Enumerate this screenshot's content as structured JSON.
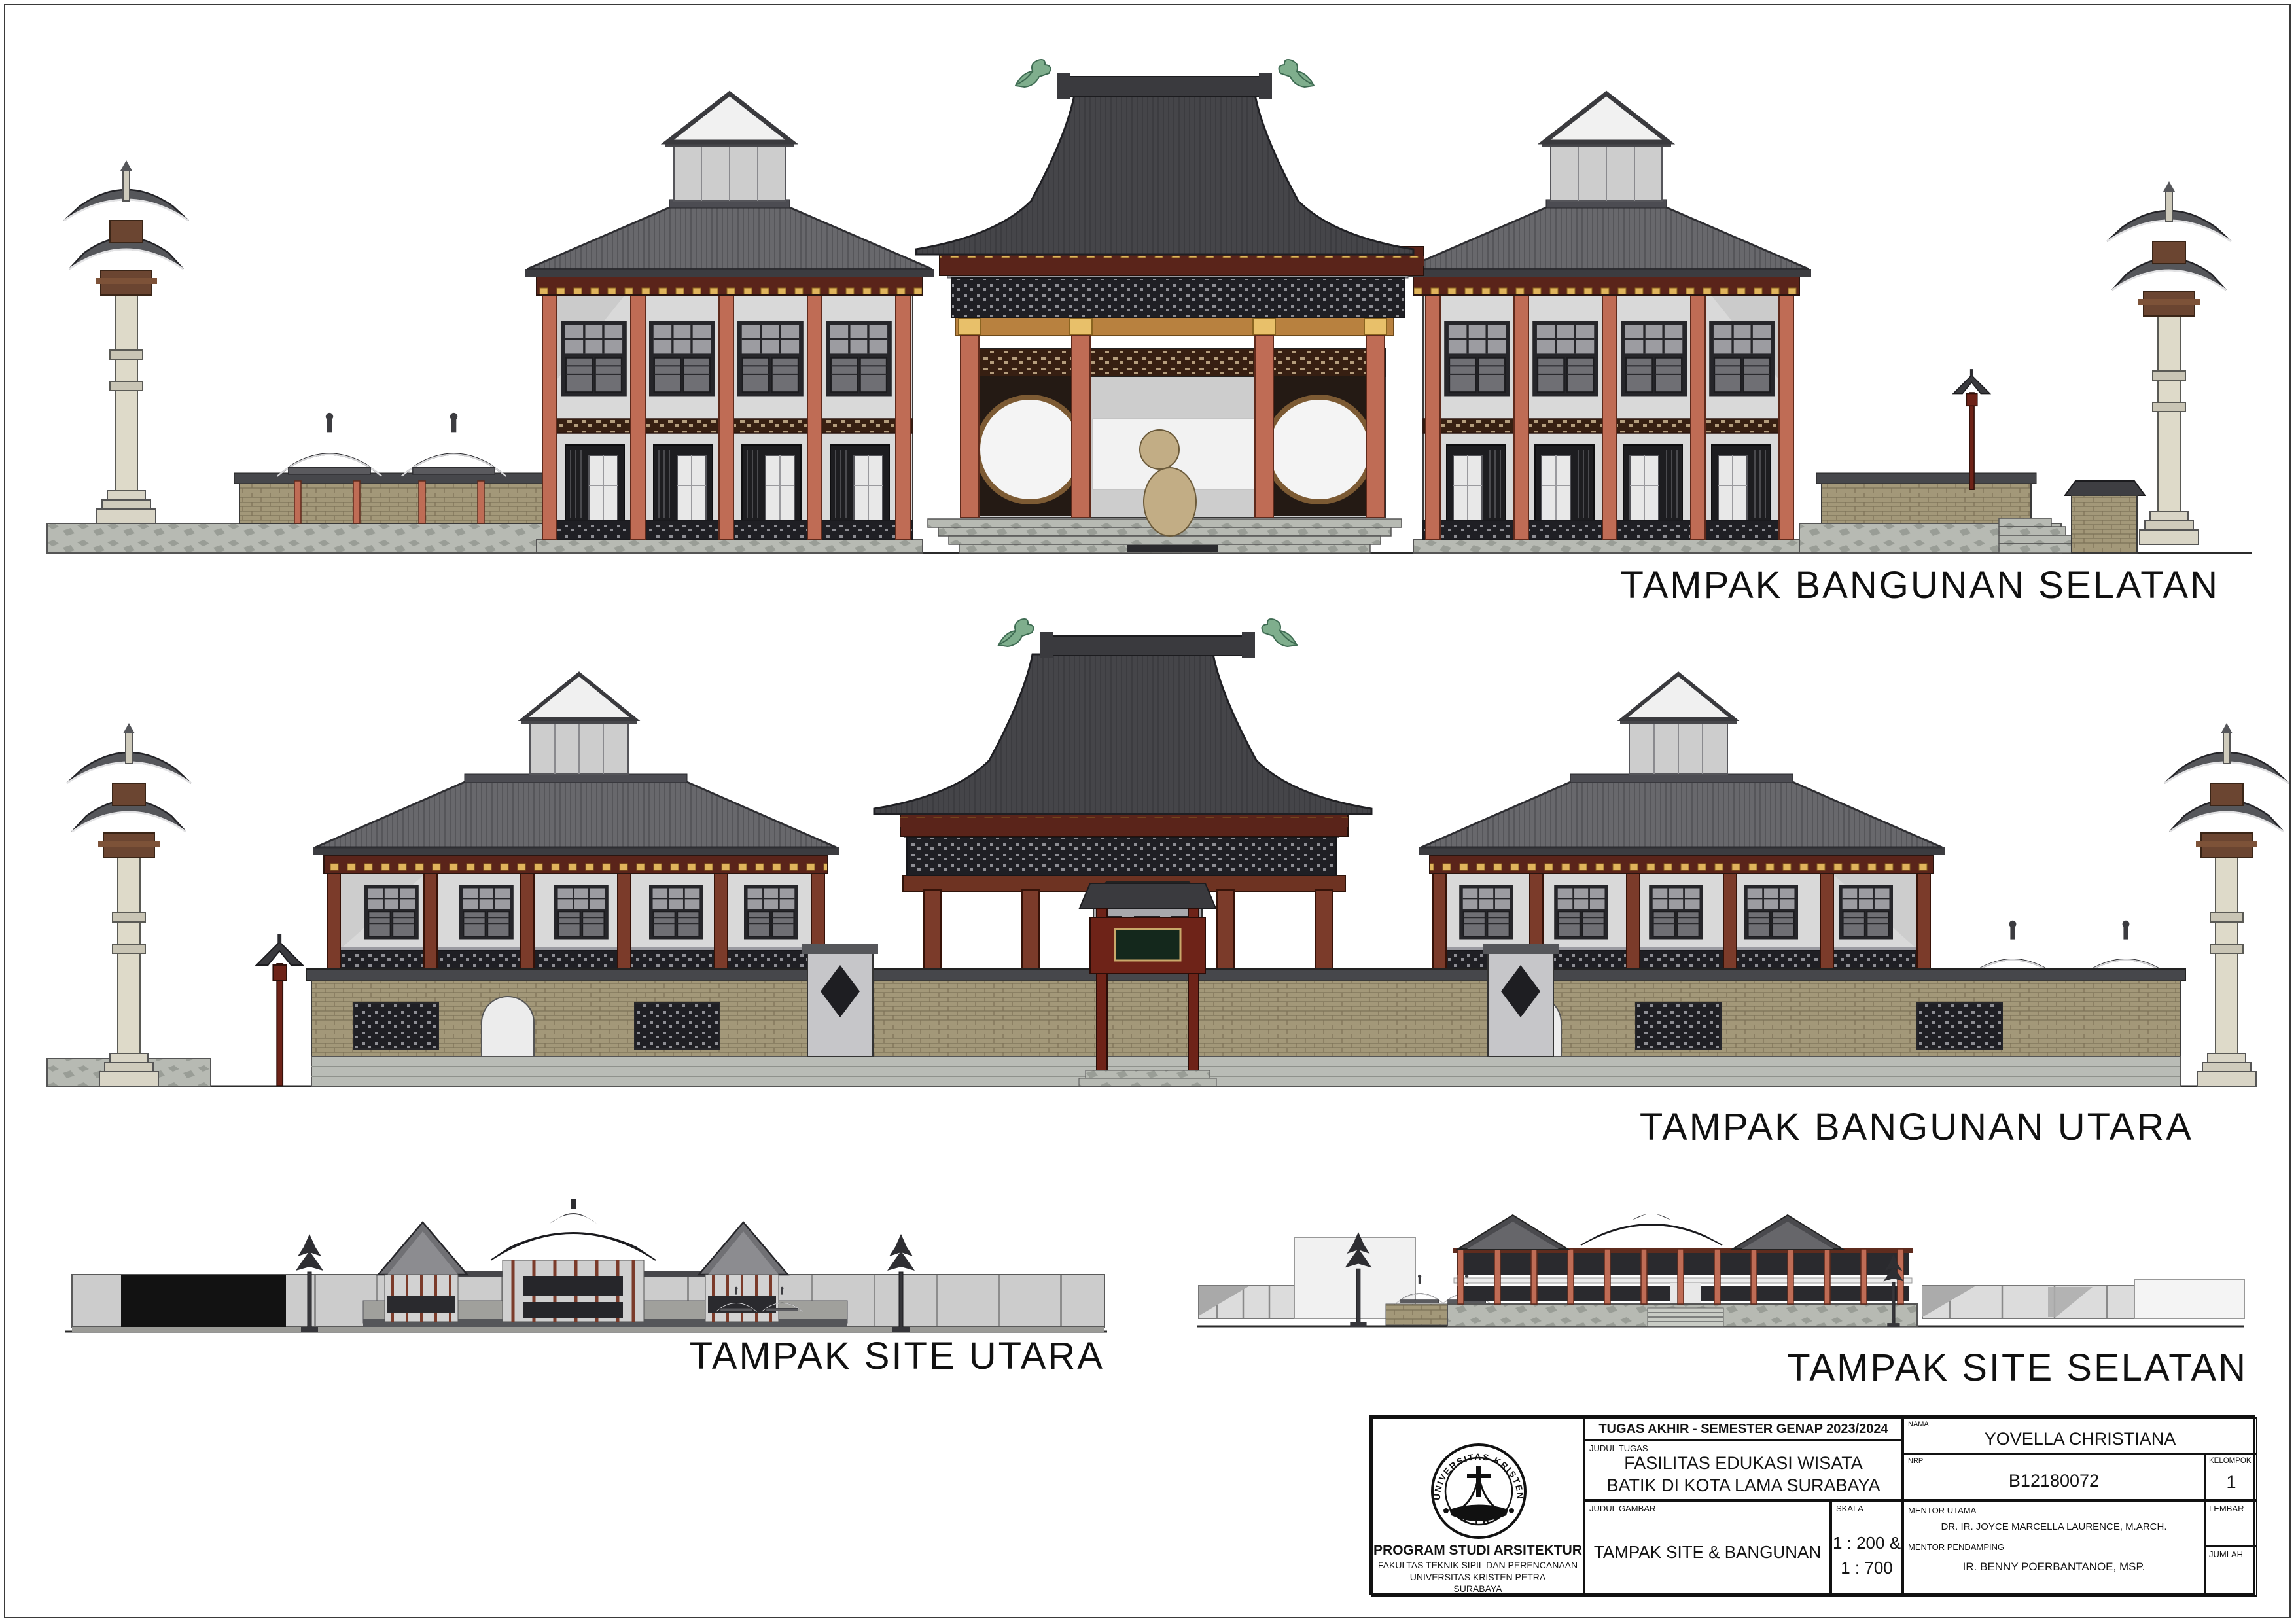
{
  "elevations": [
    {
      "label": "TAMPAK BANGUNAN SELATAN"
    },
    {
      "label": "TAMPAK BANGUNAN UTARA"
    },
    {
      "label": "TAMPAK SITE UTARA"
    },
    {
      "label": "TAMPAK SITE SELATAN"
    }
  ],
  "title_block": {
    "header": "TUGAS AKHIR - SEMESTER GENAP 2023/2024",
    "judul_tugas_label": "JUDUL TUGAS",
    "judul_tugas_line1": "FASILITAS EDUKASI WISATA",
    "judul_tugas_line2": "BATIK DI KOTA LAMA SURABAYA",
    "judul_gambar_label": "JUDUL GAMBAR",
    "judul_gambar": "TAMPAK SITE & BANGUNAN",
    "skala_label": "SKALA",
    "skala_line1": "1 : 200 &",
    "skala_line2": "1 : 700",
    "nama_label": "NAMA",
    "nama": "YOVELLA CHRISTIANA",
    "nrp_label": "NRP",
    "nrp": "B12180072",
    "kelompok_label": "KELOMPOK",
    "kelompok": "1",
    "mentor_utama_label": "MENTOR UTAMA",
    "mentor_utama": "DR. IR. JOYCE MARCELLA LAURENCE, M.ARCH.",
    "mentor_pendamping_label": "MENTOR PENDAMPING",
    "mentor_pendamping": "IR. BENNY POERBANTANOE, MSP.",
    "lembar_label": "LEMBAR",
    "lembar": "",
    "jumlah_label": "JUMLAH",
    "jumlah": "",
    "institution": {
      "line1": "PROGRAM STUDI ARSITEKTUR",
      "line2": "FAKULTAS TEKNIK SIPIL DAN PERENCANAAN",
      "line3": "UNIVERSITAS KRISTEN PETRA",
      "line4": "SURABAYA"
    },
    "logo": {
      "top_text": "UNIVERSITAS KRISTEN",
      "bottom_text": "PETRA"
    }
  },
  "colors": {
    "roof_dark": "#454549",
    "roof_gray": "#68686c",
    "column_salmon": "#bf6c55",
    "column_maroon": "#7b3b2a",
    "frieze_red": "#5a241a",
    "accent_gold": "#e0b45c",
    "brick_tan": "#a39879",
    "stone_platform": "#b7bab3",
    "finial_green": "#7fae8d",
    "ink": "#1a1a1a"
  }
}
